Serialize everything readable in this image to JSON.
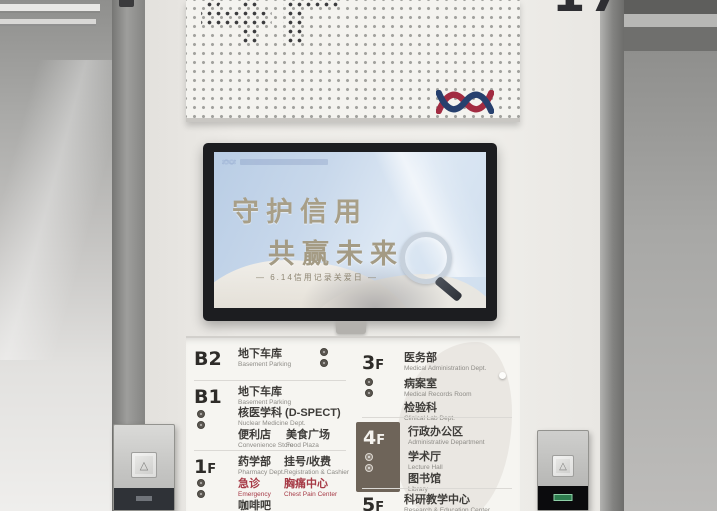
{
  "wall": {
    "floor_indicator_right": "17"
  },
  "signboard": {
    "floor_label": "4F"
  },
  "screen": {
    "title_line1": "守护信用",
    "title_line2": "共赢未来",
    "subtitle": "— 6.14信用记录关爱日 —"
  },
  "call_panel": {
    "up_button_glyph": "△"
  },
  "colors": {
    "logo_navy": "#27406e",
    "logo_red": "#a22c42",
    "floor_highlight_box": "#6e6459",
    "emergency_red": "#a63a46"
  },
  "directory": {
    "left": [
      {
        "floor_big": "B2",
        "floor_small": "",
        "rows": [
          [
            {
              "cn": "地下车库",
              "en": "Basement Parking"
            }
          ]
        ]
      },
      {
        "floor_big": "B1",
        "floor_small": "",
        "rows": [
          [
            {
              "cn": "地下车库",
              "en": "Basement Parking"
            }
          ],
          [
            {
              "cn": "核医学科 (D-SPECT)",
              "en": "Nuclear Medicine Dept."
            }
          ],
          [
            {
              "cn": "便利店",
              "en": "Convenience Store"
            },
            {
              "cn": "美食广场",
              "en": "Food Plaza"
            }
          ]
        ]
      },
      {
        "floor_big": "1",
        "floor_small": "F",
        "rows": [
          [
            {
              "cn": "药学部",
              "en": "Pharmacy Dept."
            },
            {
              "cn": "挂号/收费",
              "en": "Registration & Cashier"
            }
          ],
          [
            {
              "cn": "急诊",
              "en": "Emergency"
            },
            {
              "cn": "胸痛中心",
              "en": "Chest Pain Center"
            }
          ],
          [
            {
              "cn": "咖啡吧",
              "en": "Cafe"
            }
          ]
        ]
      }
    ],
    "right": [
      {
        "floor_big": "3",
        "floor_small": "F",
        "rows": [
          [
            {
              "cn": "医务部",
              "en": "Medical Administration Dept."
            }
          ],
          [
            {
              "cn": "病案室",
              "en": "Medical Records Room"
            }
          ],
          [
            {
              "cn": "检验科",
              "en": "Clinical Lab Dept."
            }
          ]
        ]
      },
      {
        "floor_big": "4",
        "floor_small": "F",
        "rows": [
          [
            {
              "cn": "行政办公区",
              "en": "Administrative Department"
            }
          ],
          [
            {
              "cn": "学术厅",
              "en": "Lecture Hall"
            }
          ],
          [
            {
              "cn": "图书馆",
              "en": "Library"
            }
          ]
        ]
      },
      {
        "floor_big": "5",
        "floor_small": "F",
        "rows": [
          [
            {
              "cn": "科研教学中心",
              "en": "Research & Education Center"
            }
          ]
        ]
      }
    ]
  }
}
